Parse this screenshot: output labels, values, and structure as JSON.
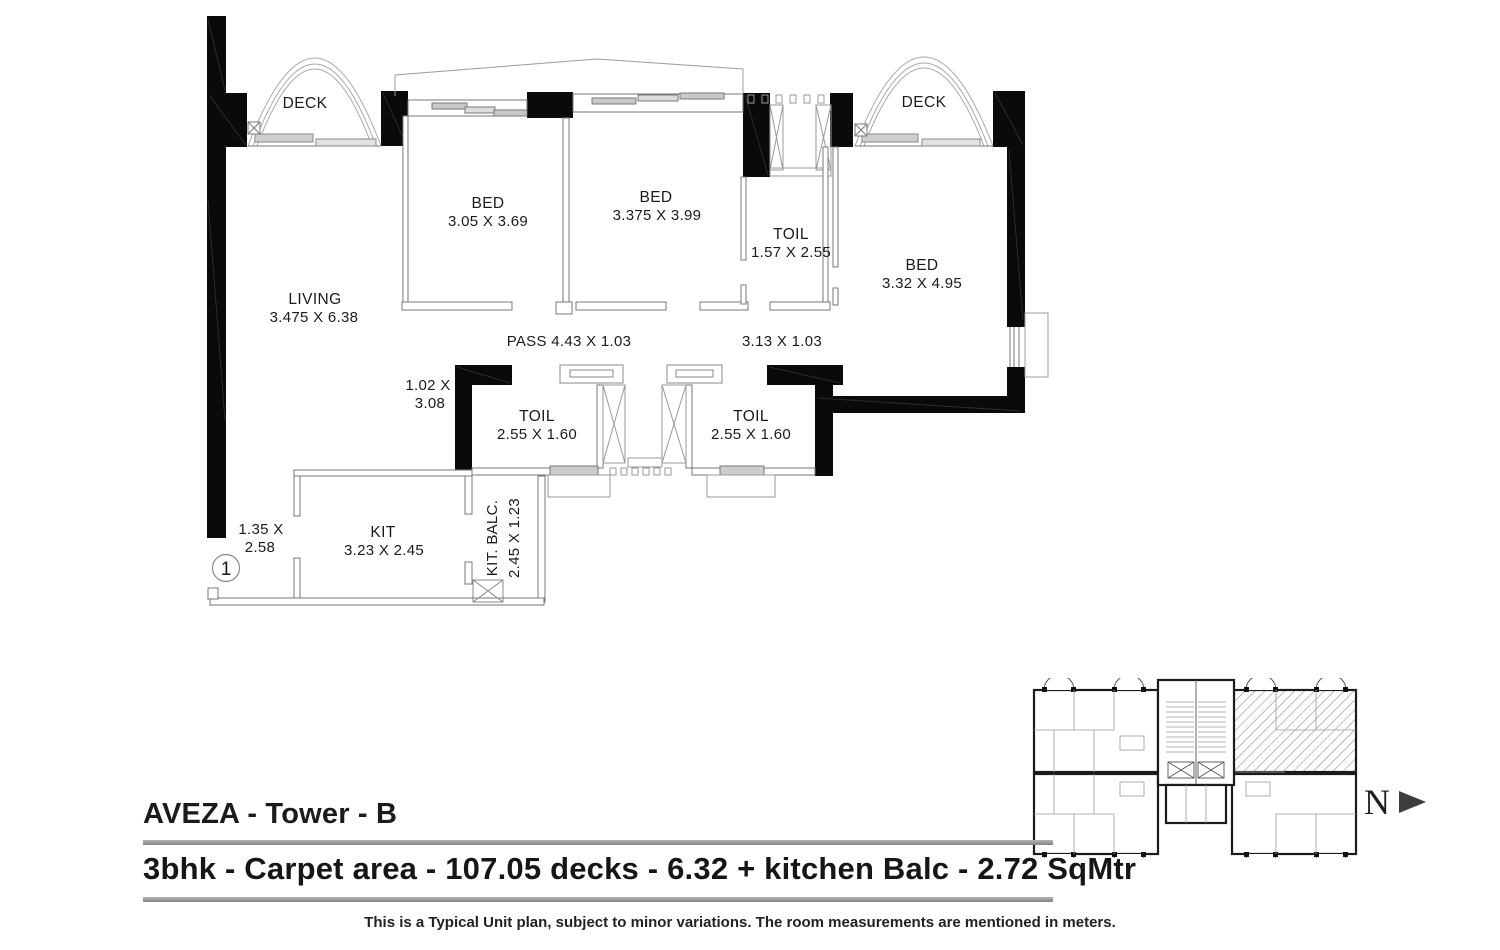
{
  "rooms": {
    "deck_left": {
      "name": "DECK"
    },
    "deck_right": {
      "name": "DECK"
    },
    "bed1": {
      "name": "BED",
      "dims": "3.05 X 3.69"
    },
    "bed2": {
      "name": "BED",
      "dims": "3.375 X 3.99"
    },
    "bed3": {
      "name": "BED",
      "dims": "3.32 X 4.95"
    },
    "toil_top": {
      "name": "TOIL",
      "dims": "1.57 X 2.55"
    },
    "toil_left": {
      "name": "TOIL",
      "dims": "2.55 X 1.60"
    },
    "toil_right": {
      "name": "TOIL",
      "dims": "2.55 X 1.60"
    },
    "living": {
      "name": "LIVING",
      "dims": "3.475 X 6.38"
    },
    "pass": {
      "label": "PASS 4.43 X 1.03"
    },
    "pass_right": {
      "label": "3.13 X 1.03"
    },
    "passage_dim": {
      "line1": "1.02 X",
      "line2": "3.08"
    },
    "foyer_dim": {
      "line1": "1.35 X",
      "line2": "2.58"
    },
    "kit": {
      "name": "KIT",
      "dims": "3.23 X 2.45"
    },
    "kit_balc": {
      "name": "KIT. BALC.",
      "dims": "2.45 X 1.23"
    }
  },
  "unit_marker": {
    "number": "1"
  },
  "north": {
    "label": "N"
  },
  "footer": {
    "title": "AVEZA - Tower - B",
    "subtitle": "3bhk - Carpet area - 107.05 decks - 6.32 + kitchen Balc - 2.72 SqMtr",
    "footnote": "This is a Typical Unit plan, subject to minor variations. The room measurements are mentioned in meters."
  },
  "colors": {
    "wall": "#0a0a0a",
    "thin_line": "#8a8a8a",
    "rule": "#9a9a9a",
    "text": "#1b1b1b"
  }
}
